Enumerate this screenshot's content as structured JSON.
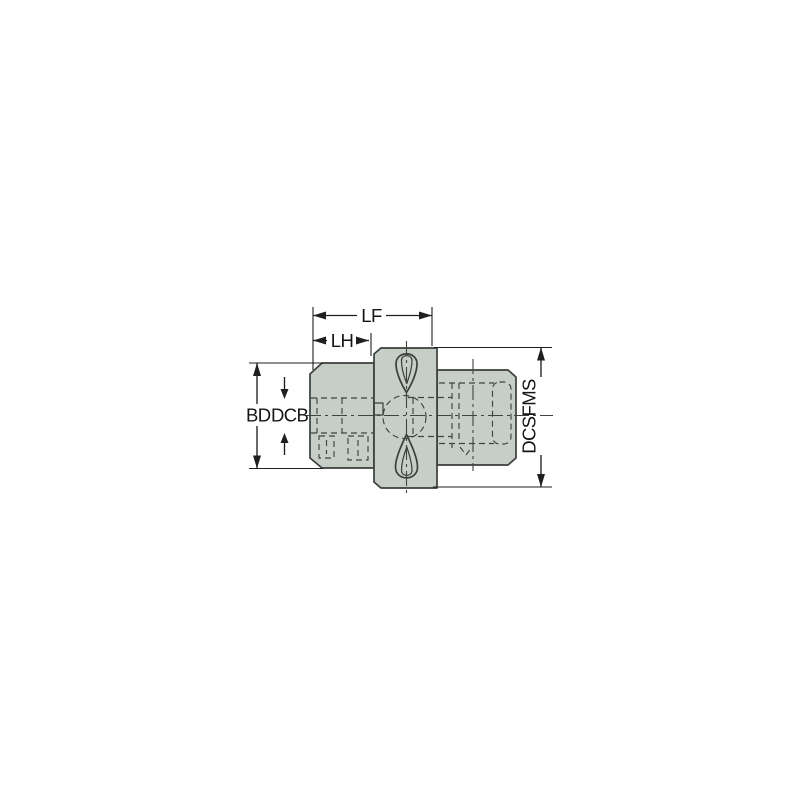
{
  "colors": {
    "background": "#ffffff",
    "part_fill": "#c7cdc7",
    "outline": "#3a3f3c",
    "dimension": "#1f1f1f"
  },
  "drawing": {
    "title": "tool-coupling-adapter-side-view",
    "labels": {
      "lf": "LF",
      "lh": "LH",
      "bd": "BD",
      "dcb": "DCB",
      "dcsfms": "DCSFMS"
    }
  }
}
